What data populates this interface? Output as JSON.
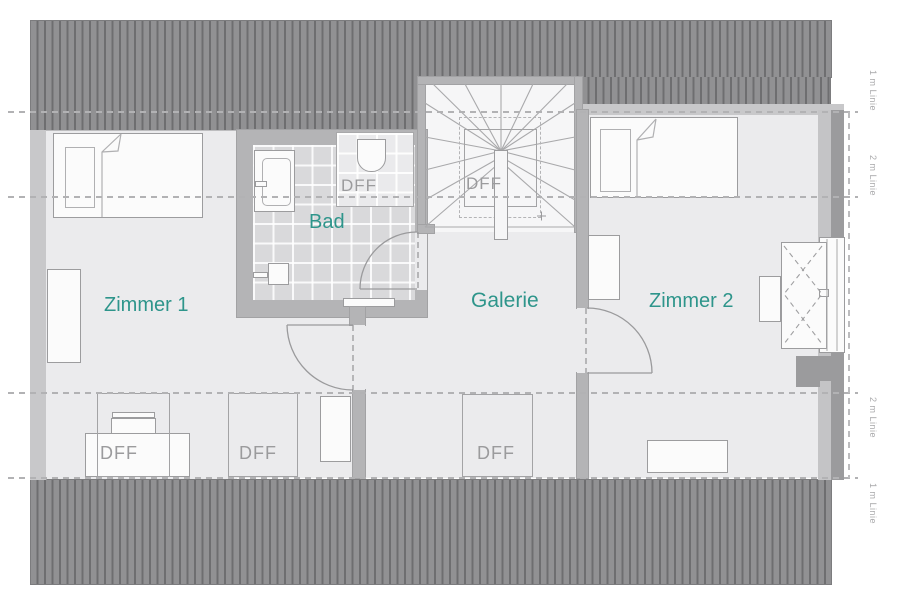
{
  "plan": {
    "rooms": {
      "zimmer1": "Zimmer 1",
      "bad": "Bad",
      "galerie": "Galerie",
      "zimmer2": "Zimmer 2"
    },
    "roof_window_label": "DFF",
    "guides": {
      "one_m": "1 m Linie",
      "two_m": "2 m Linie"
    },
    "colors": {
      "room_label": "#2e958b",
      "dff_label": "#9b9b9d",
      "roof_hatch": "#8f8f91",
      "wall": "#b4b4b6",
      "tile": "#d9d9db"
    }
  }
}
